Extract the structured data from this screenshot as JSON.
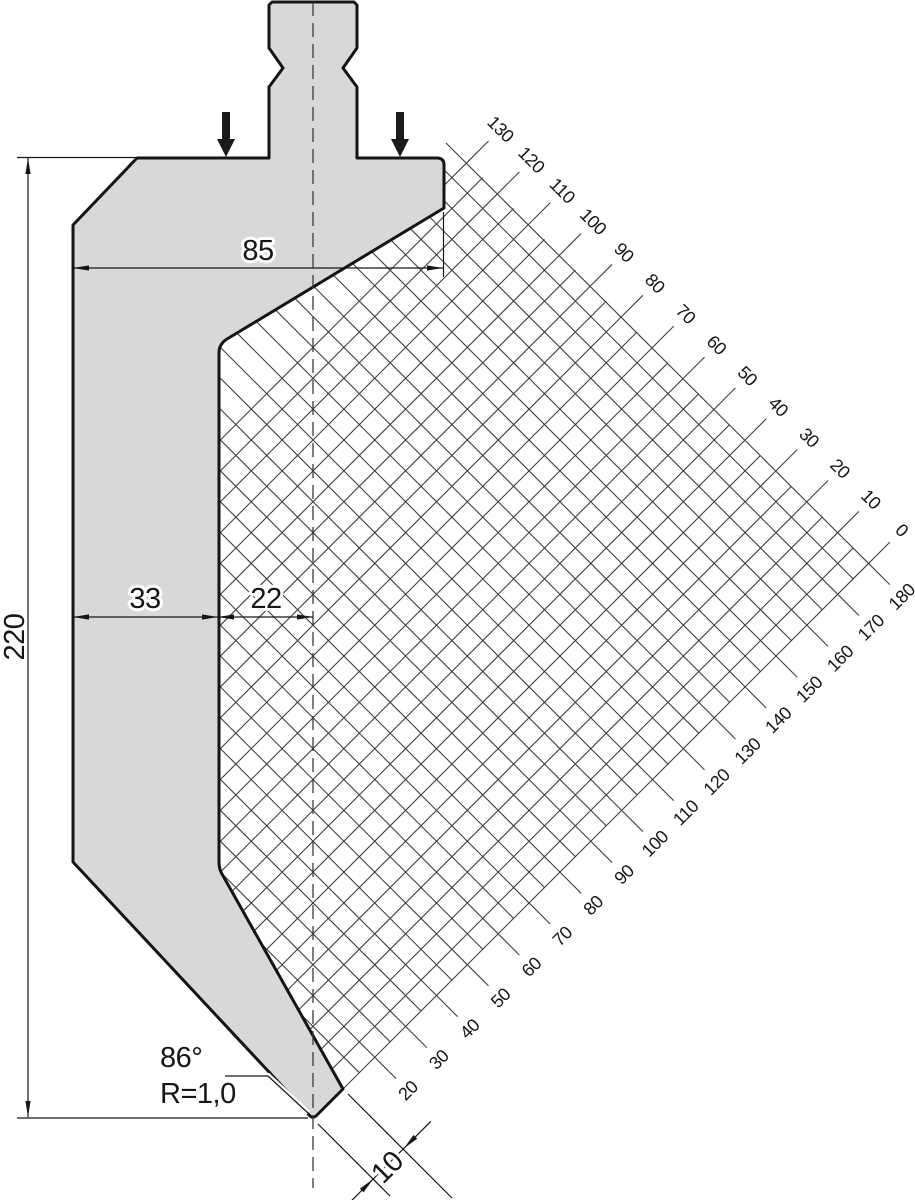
{
  "dimensions": {
    "top_width": "85",
    "body_width": "33",
    "tip_offset": "22",
    "total_height": "220",
    "tip_drop": "10",
    "tip_angle": "86°",
    "tip_radius": "R=1,0"
  },
  "scales": {
    "upper": [
      "130",
      "120",
      "110",
      "100",
      "90",
      "80",
      "70",
      "60",
      "50",
      "40",
      "30",
      "20",
      "10",
      "0"
    ],
    "lower": [
      "180",
      "170",
      "160",
      "150",
      "140",
      "130",
      "120",
      "110",
      "100",
      "90",
      "80",
      "70",
      "60",
      "50",
      "40",
      "30",
      "20"
    ]
  },
  "colors": {
    "body_fill": "#d8d8d8",
    "outline": "#141414",
    "grid_line": "#3f3f3f",
    "dimension": "#161616",
    "background": "#ffffff"
  }
}
